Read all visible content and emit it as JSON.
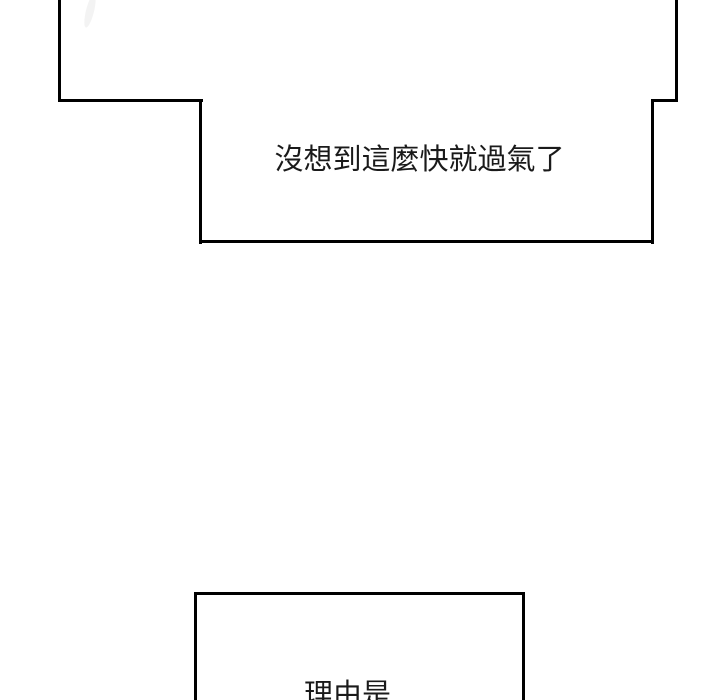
{
  "page": {
    "background_color": "#ffffff",
    "panel_border_color": "#000000",
    "text_color": "#1a1a1a"
  },
  "panels": {
    "top": {
      "dialogue": "沒想到這麼快就過氣了"
    },
    "bottom": {
      "dialogue": "理由是"
    }
  }
}
